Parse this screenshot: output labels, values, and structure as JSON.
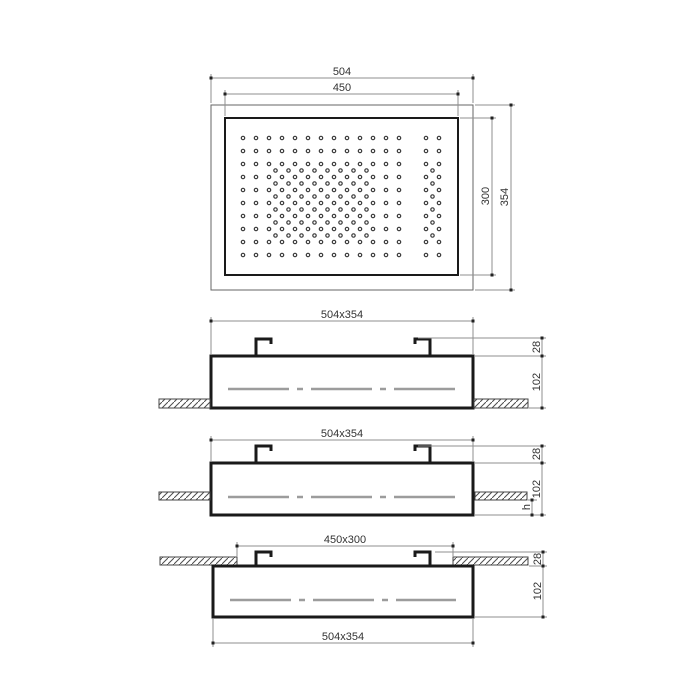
{
  "drawing": {
    "title": "ceiling shower head installation drawing",
    "top_view": {
      "width_outer": "504",
      "width_inner": "450",
      "height_inner": "300",
      "height_outer": "354",
      "nozzles": {
        "rows": 10,
        "main_cols": 13,
        "spacing": 13,
        "start_x": 243,
        "start_y": 138,
        "right_col_x": [
          426,
          439
        ],
        "dense_offset": {
          "row_start": 2,
          "row_end": 7,
          "col_start": 2,
          "col_end": 9
        },
        "zigzag_x": 432.5
      }
    },
    "view_recessed": {
      "size": "504x354",
      "clip": "28",
      "height": "102"
    },
    "view_semi": {
      "size": "504x354",
      "clip": "28",
      "height": "102",
      "protrusion": "h"
    },
    "view_surface": {
      "opening": "450x300",
      "clip": "28",
      "height": "102",
      "size": "504x354"
    }
  },
  "colors": {
    "line": "#1a1a1a",
    "thin": "#8f8f8f",
    "centerline": "#9c9c9c",
    "text": "#333333",
    "hatch": "#4d4d4d",
    "background": "#ffffff"
  }
}
